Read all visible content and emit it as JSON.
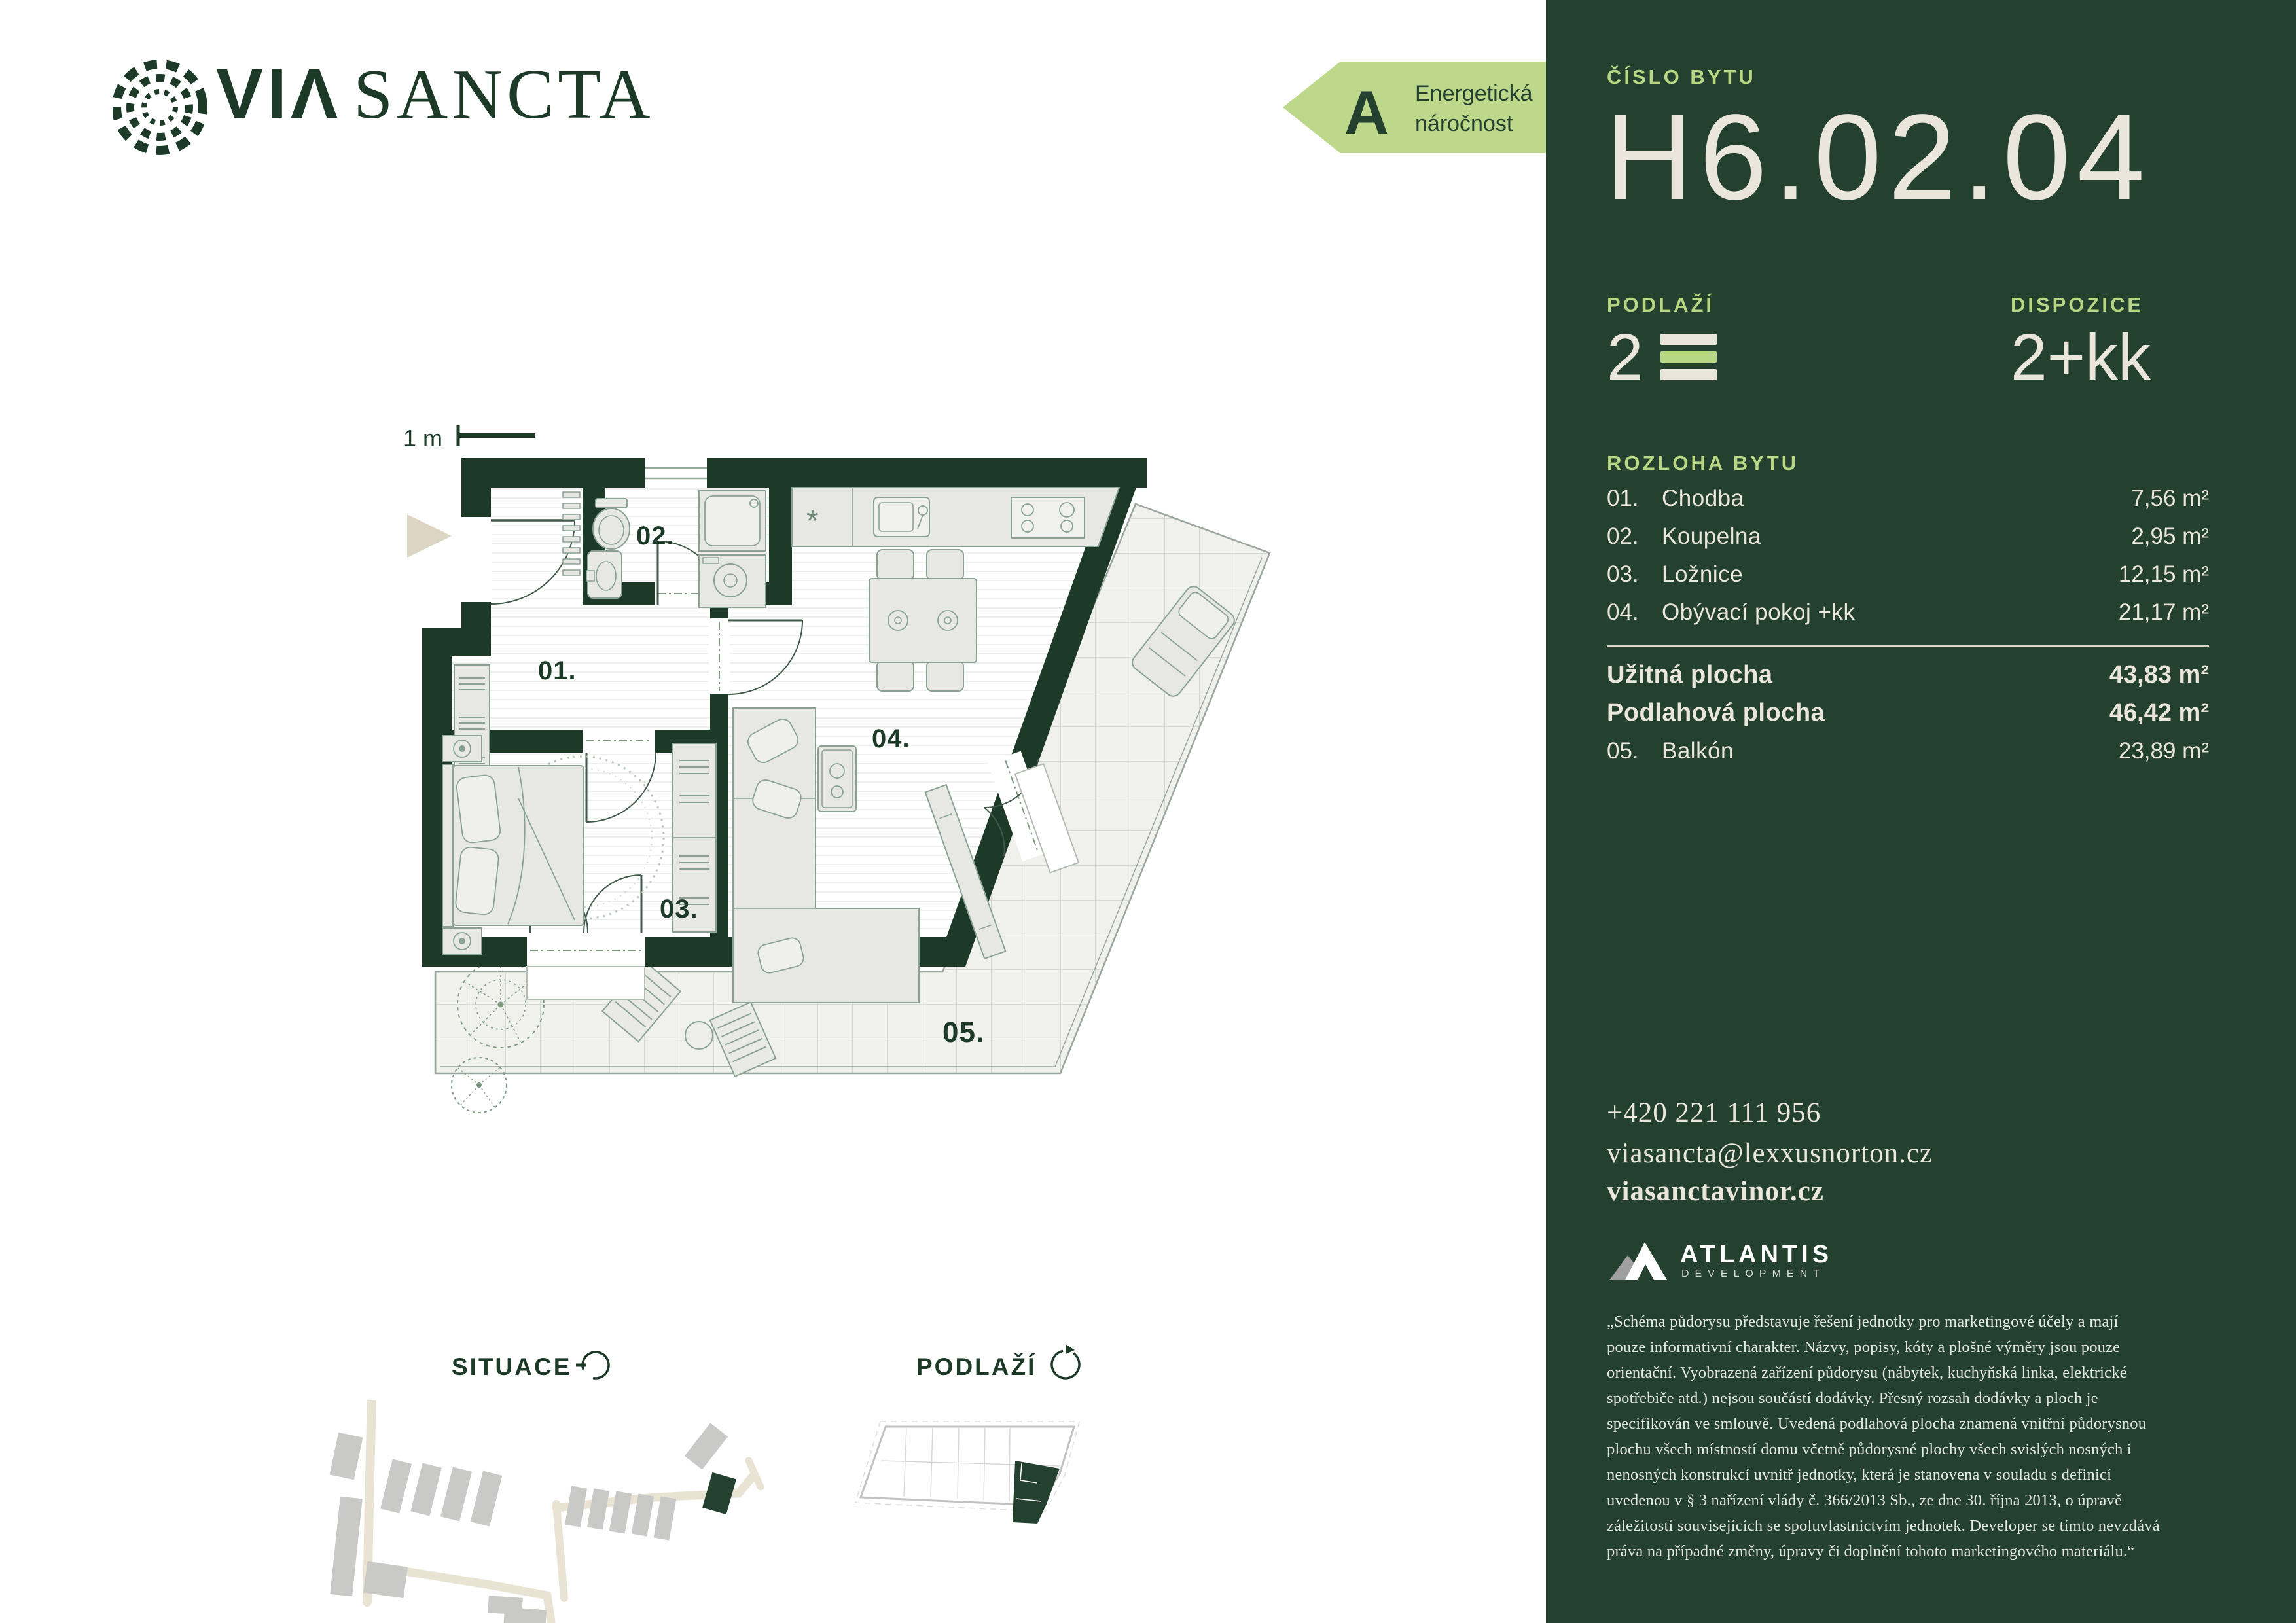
{
  "brand": {
    "logo_via": "VIΛ",
    "logo_sancta": "SANCTA"
  },
  "energy_badge": {
    "grade": "A",
    "line1": "Energetická",
    "line2": "náročnost"
  },
  "panel": {
    "unit_label": "ČÍSLO BYTU",
    "unit_number": "H6.02.04",
    "floor_label": "PODLAŽÍ",
    "floor_value": "2",
    "disposition_label": "DISPOZICE",
    "disposition_value": "2+kk",
    "area_section_label": "ROZLOHA BYTU",
    "rooms": [
      {
        "num": "01.",
        "name": "Chodba",
        "area": "7,56 m²"
      },
      {
        "num": "02.",
        "name": "Koupelna",
        "area": "2,95 m²"
      },
      {
        "num": "03.",
        "name": "Ložnice",
        "area": "12,15 m²"
      },
      {
        "num": "04.",
        "name": "Obývací pokoj +kk",
        "area": "21,17 m²"
      }
    ],
    "usable_area_label": "Užitná plocha",
    "usable_area_value": "43,83 m²",
    "floor_area_label": "Podlahová plocha",
    "floor_area_value": "46,42 m²",
    "balcony_num": "05.",
    "balcony_name": "Balkón",
    "balcony_area": "23,89 m²",
    "contact": {
      "phone": "+420 221 111 956",
      "email": "viasancta@lexxusnorton.cz",
      "website": "viasanctavinor.cz"
    },
    "developer": {
      "name": "ATLANTIS",
      "subtitle": "DEVELOPMENT"
    },
    "disclaimer": "„Schéma půdorysu představuje řešení jednotky pro marketingové účely a mají pouze informativní charakter. Názvy, popisy, kóty a plošné výměry jsou pouze orientační. Vyobrazená zařízení půdorysu (nábytek, kuchyňská linka, elektrické spotřebiče atd.) nejsou součástí dodávky. Přesný rozsah dodávky a ploch je specifikován ve smlouvě. Uvedená podlahová plocha znamená vnitřní půdorysnou plochu všech místností domu včetně půdorysné plochy všech svislých nosných i nenosných konstrukcí uvnitř jednotky, která je stanovena v souladu s definicí uvedenou v § 3 nařízení vlády č. 366/2013 Sb., ze dne 30. října 2013, o úpravě záležitostí souvisejících se spoluvlastnictvím jednotek. Developer se tímto nevzdává práva na případné změny, úpravy či doplnění tohoto marketingového materiálu.“"
  },
  "plan": {
    "scale_label": "1 m",
    "labels": {
      "r01": "01.",
      "r02": "02.",
      "r03": "03.",
      "r04": "04.",
      "r05": "05."
    }
  },
  "minimaps": {
    "situace_label": "SITUACE",
    "podlazi_label": "PODLAŽÍ"
  },
  "colors": {
    "panel_green": "#24402e",
    "wall_green": "#1d3a29",
    "accent_green": "#b7d784",
    "cream": "#eae6dc",
    "beige": "#ddd5c3"
  }
}
